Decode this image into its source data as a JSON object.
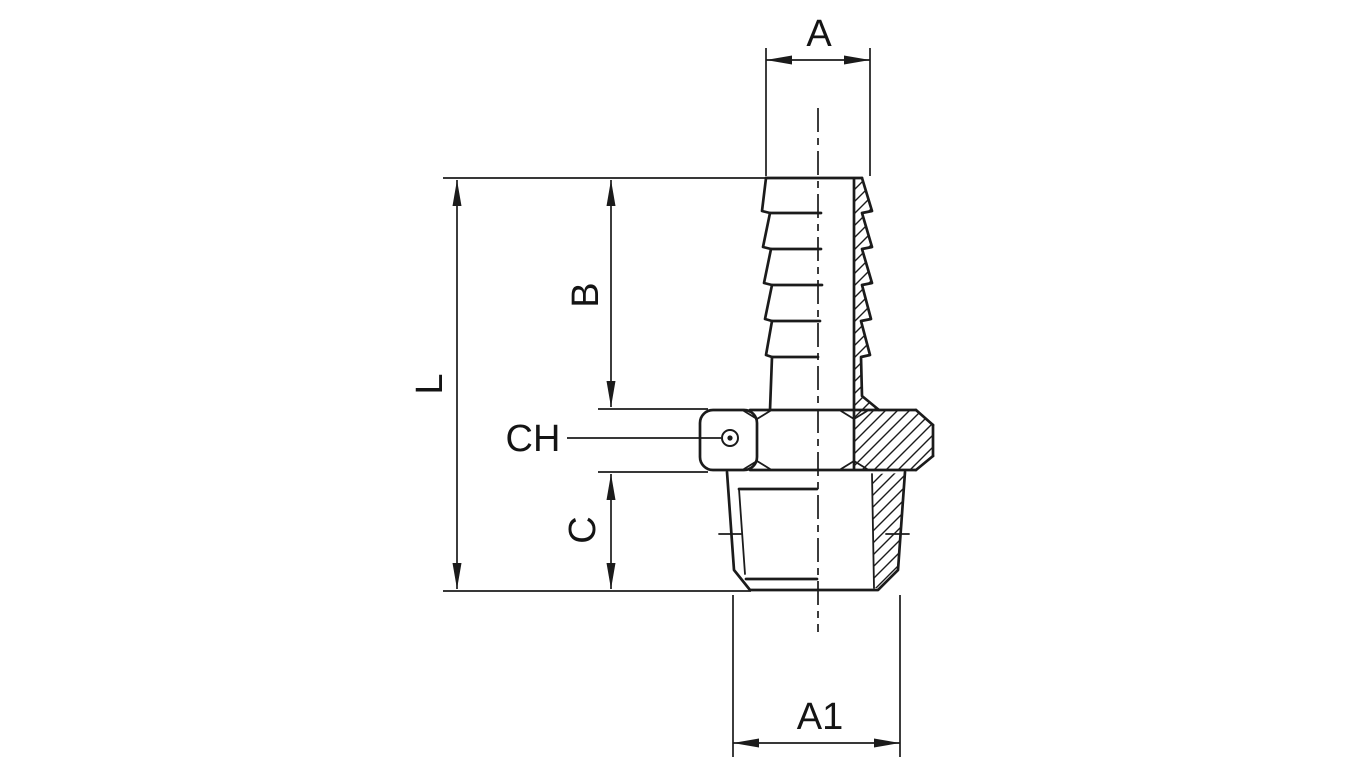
{
  "drawing": {
    "kind": "technical-dimension-drawing",
    "subject": "Hose barb adapter with male taper thread, side view in half section",
    "background_color": "#ffffff",
    "line_color": "#1b1b1b",
    "labels": {
      "barb_outer_diameter": "A",
      "overall_length": "L",
      "barb_length": "B",
      "hex_size": "CH",
      "thread_length": "C",
      "thread_outer_diameter": "A1"
    }
  }
}
